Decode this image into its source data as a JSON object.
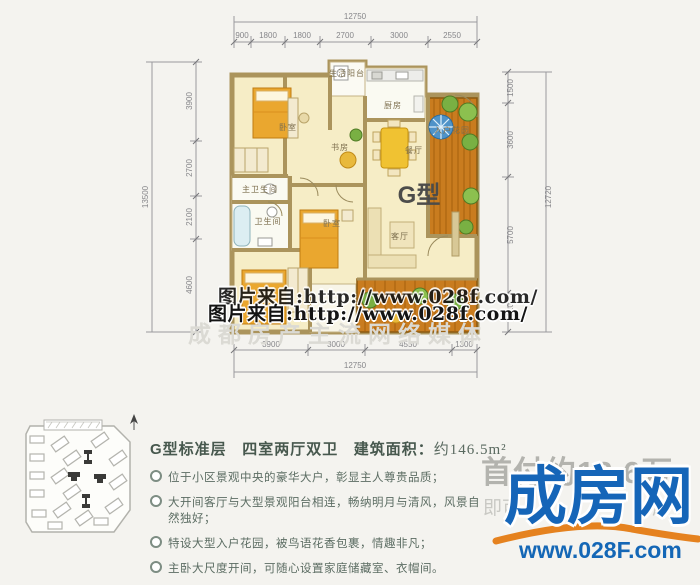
{
  "floorplan": {
    "type_label": "G型",
    "room_labels": {
      "bedroom_top": "卧室",
      "study": "书房",
      "living_balcony": "生活阳台",
      "kitchen": "厨房",
      "dining": "餐厅",
      "entry_garden": "入户花园",
      "master_bath": "主卫生间",
      "bath": "卫生间",
      "bedroom_mid": "卧室",
      "living": "客厅"
    },
    "dims": {
      "top": {
        "total": "12750",
        "segments": [
          "900",
          "1800",
          "1800",
          "2700",
          "3000",
          "2550"
        ]
      },
      "bottom": {
        "total": "12750",
        "segments": [
          "3900",
          "3000",
          "4550",
          "1300"
        ]
      },
      "left": {
        "total": "13500",
        "segments": [
          "3900",
          "2700",
          "2100",
          "4600"
        ]
      },
      "right": {
        "total": "12720",
        "segments": [
          "1500",
          "3600",
          "5700",
          "1920"
        ]
      }
    }
  },
  "watermark": {
    "photo_line": "图片来自:http://www.028f.com/",
    "media_line": "成都房产主流网络媒体"
  },
  "info": {
    "title_type": "G型标准层",
    "title_layout": "四室两厅双卫",
    "area_label": "建筑面积：",
    "area_value": "约146.5m²",
    "bullets": [
      "位于小区景观中央的豪华大户，彰显主人尊贵品质；",
      "大开间客厅与大型景观阳台相连，畅纳明月与清风，风景自然独好；",
      "特设大型入户花园，被鸟语花香包裹，情趣非凡；",
      "主卧大尺度开间，可随心设置家庭储藏室、衣帽间。"
    ]
  },
  "promo": {
    "downpay": "首付约12.6万",
    "sub_left": "即可",
    "sub_right": "房",
    "logo": "成房网",
    "site_url": "www.028F.com"
  },
  "colors": {
    "logo_blue": "#1565b8",
    "swoosh_orange": "#e5821f",
    "wall_tan": "#ab945c",
    "room_yellow": "#f6edc6",
    "deck_orange": "#c97c1f",
    "furniture_orange": "#eaa72f"
  }
}
